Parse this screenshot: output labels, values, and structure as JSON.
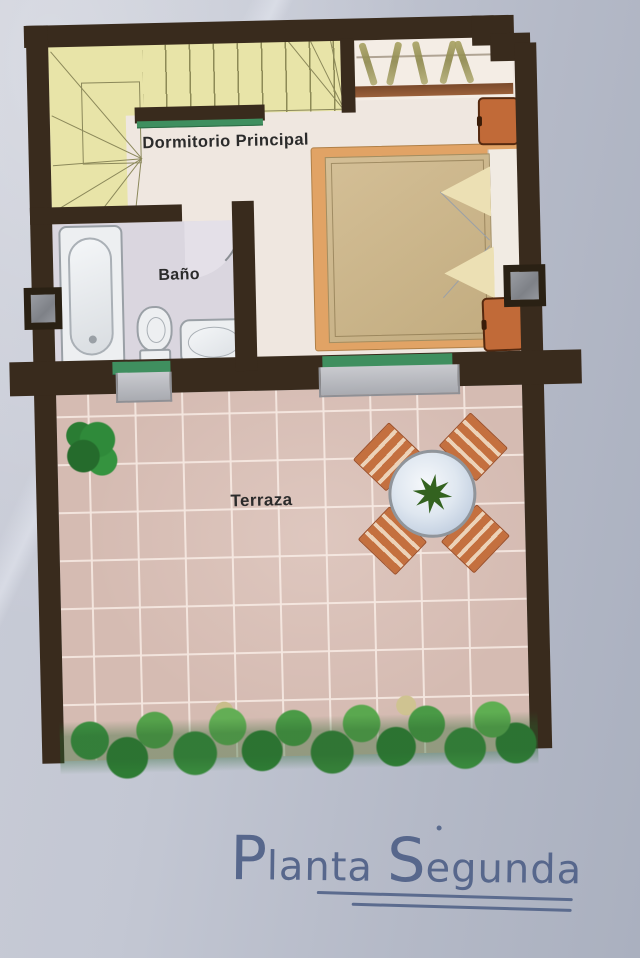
{
  "plan": {
    "rooms": [
      {
        "id": "dormitorio",
        "label": "Dormitorio  Principal"
      },
      {
        "id": "bano",
        "label": "Baño"
      },
      {
        "id": "terraza",
        "label": "Terraza"
      }
    ],
    "title": {
      "full": "Planta Segunda",
      "word1": "Planta",
      "word2": "Segunda"
    }
  },
  "colors": {
    "paper": "#bfc3cf",
    "wall": "#392b1d",
    "stair": "#e8e4a8",
    "bedroom_floor": "#efe7e0",
    "bathroom_floor": "#dad6df",
    "terrace_tile": "#d5bbb2",
    "tile_grout": "#f4e6df",
    "bed_frame": "#e1a365",
    "bedspread": "#cdb990",
    "nightstand": "#c16a38",
    "chair": "#c4703f",
    "table_top": "#dfe7f0",
    "plant_green": "#3f9340",
    "door_sill_green": "#3f8f5f",
    "step_gray": "#b4b5ba",
    "title_ink": "#57678c"
  }
}
